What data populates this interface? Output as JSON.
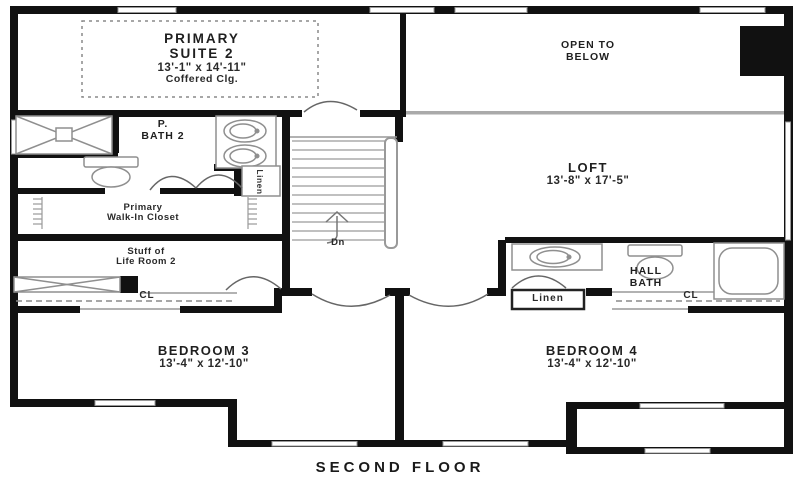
{
  "title": "SECOND FLOOR",
  "rooms": {
    "primary_suite": {
      "line1": "PRIMARY",
      "line2": "SUITE 2",
      "dims": "13'-1\" x 14'-11\"",
      "note": "Coffered Clg."
    },
    "open_to_below": {
      "line1": "OPEN TO",
      "line2": "BELOW"
    },
    "primary_bath": {
      "line1": "P.",
      "line2": "BATH 2"
    },
    "loft": {
      "name": "LOFT",
      "dims": "13'-8\" x 17'-5\""
    },
    "walk_in_closet": {
      "line1": "Primary",
      "line2": "Walk-In Closet"
    },
    "stuff_of_life": {
      "line1": "Stuff of",
      "line2": "Life Room 2"
    },
    "hall_bath": {
      "line1": "HALL",
      "line2": "BATH"
    },
    "bedroom_3": {
      "name": "BEDROOM 3",
      "dims": "13'-4\" x 12'-10\""
    },
    "bedroom_4": {
      "name": "BEDROOM 4",
      "dims": "13'-4\" x 12'-10\""
    }
  },
  "labels": {
    "linen_primary": "Linen",
    "linen_hall": "Linen",
    "closet_bedroom3": "CL",
    "closet_bedroom4": "CL",
    "stairs_direction": "Dn"
  },
  "colors": {
    "wall": "#111111",
    "thin_line": "#999999",
    "railing": "#aaaaaa",
    "text": "#1f1f1f",
    "background": "#ffffff"
  }
}
